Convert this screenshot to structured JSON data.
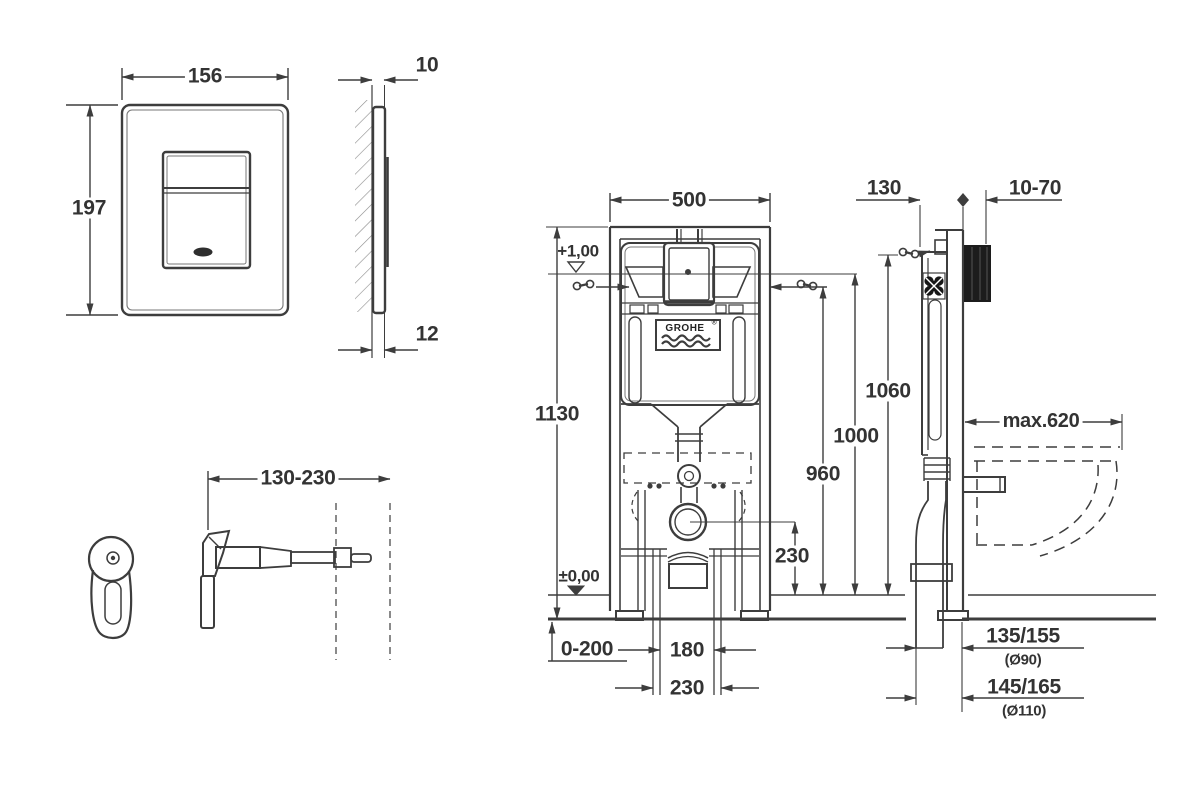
{
  "plate_front": {
    "width": "156",
    "height": "197"
  },
  "plate_side": {
    "top_offset": "10",
    "bottom_offset": "12"
  },
  "bracket": {
    "range": "130-230"
  },
  "frame_front": {
    "width": "500",
    "height": "1130",
    "level_top": "+1,00",
    "level_floor": "±0,00",
    "outlet_height": "230",
    "floor_buildup": "0-200",
    "fixing_inner": "180",
    "fixing_outer": "230",
    "logo": "GROHE",
    "logo_reg": "®"
  },
  "frame_side": {
    "depth": "130",
    "plate_range": "10-70",
    "h_small": "960",
    "h_mid": "1000",
    "h_large": "1060",
    "max_depth": "max.620",
    "outlet_a": "135/155",
    "outlet_a_dia": "(Ø90)",
    "outlet_b": "145/165",
    "outlet_b_dia": "(Ø110)"
  },
  "colors": {
    "line": "#3d3d3d",
    "wall_block": "#1c1c1c",
    "background": "#ffffff"
  }
}
